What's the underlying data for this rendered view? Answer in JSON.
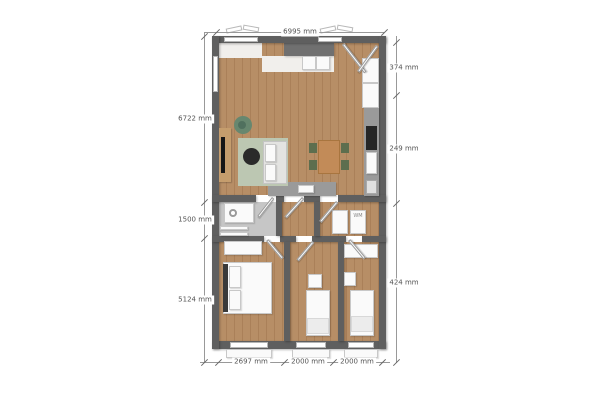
{
  "floorplan": {
    "unit": "mm",
    "dimensions": {
      "top_width": "6995 mm",
      "left_upper": "6722 mm",
      "left_middle": "1500 mm",
      "left_lower": "5124 mm",
      "right_upper": "374 mm",
      "right_middle": "249 mm",
      "right_lower": "424 mm",
      "bottom_left_room": "2697 mm",
      "bottom_middle_room": "2000 mm",
      "bottom_right_room": "2000 mm"
    },
    "labels": {
      "washing_machine": "WM"
    },
    "colors": {
      "canvas": "#ffffff",
      "wall": "#5f5f5f",
      "wall_light": "#707070",
      "wood1": "#b78e66",
      "wood2": "#aa8059",
      "bath_floor": "#c6c6c6",
      "white_floor": "#f1efec",
      "furniture_white": "#fafafa",
      "furniture_border": "#c8c8c8",
      "rug": "#bcc7b2",
      "sofa": "#e3e3e1",
      "coffee_table": "#2a2a2a",
      "sideboard": "#c59d6d",
      "tv": "#161616",
      "plant": "#67876f",
      "plant_dark": "#50705e",
      "dining_table": "#c28b58",
      "chair": "#5d6e4e",
      "counter": "#9a9a9a",
      "appliance_dark": "#262626",
      "dim_line": "#999999",
      "dim_text": "#555555"
    }
  }
}
